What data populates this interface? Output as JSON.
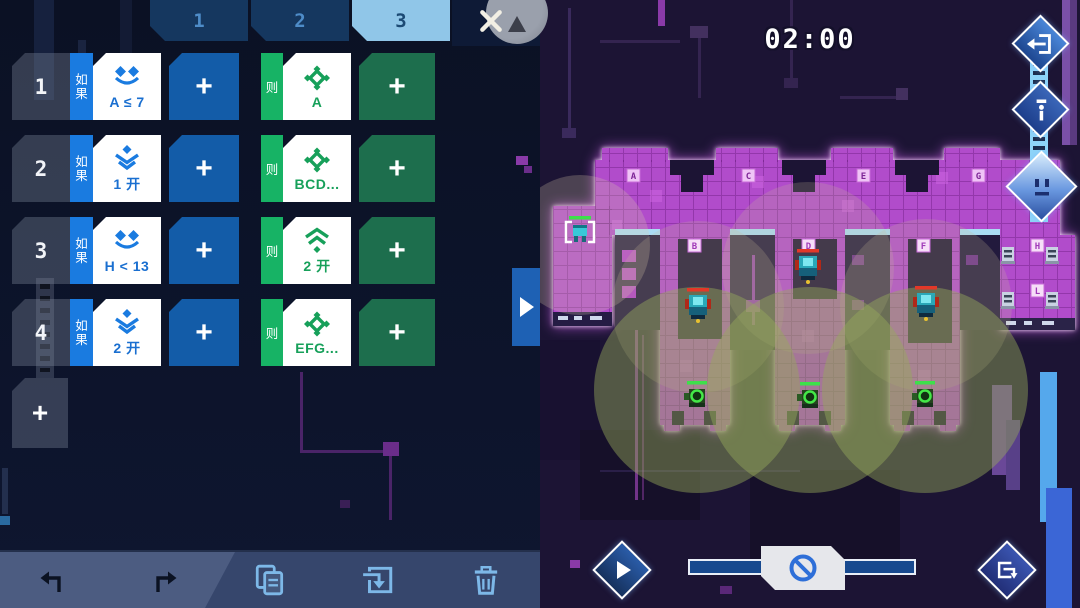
{
  "colors": {
    "accent_blue": "#1a7be0",
    "accent_green": "#17b365",
    "card_text_blue": "#1a6fd0",
    "card_text_green": "#17a05a",
    "map_magenta": "#b14ccb",
    "toolbar_icon_blue": "#7db8e8",
    "side_strip_blue": "#8ed4f8"
  },
  "left_panel": {
    "tabs": [
      {
        "label": "1"
      },
      {
        "label": "2"
      },
      {
        "label": "3",
        "active": true
      }
    ],
    "rules": [
      {
        "index": "1",
        "if_label": "如果",
        "condition_icon": "scan-eyes-icon",
        "condition": "A ≤ 7",
        "add_condition": "+",
        "then_label": "则",
        "action_icon": "move-target-icon",
        "action": "A",
        "add_action": "+"
      },
      {
        "index": "2",
        "if_label": "如果",
        "condition_icon": "stack-down-icon",
        "condition": "1 开",
        "add_condition": "+",
        "then_label": "则",
        "action_icon": "move-target-icon",
        "action": "BCD...",
        "add_action": "+"
      },
      {
        "index": "3",
        "if_label": "如果",
        "condition_icon": "scan-eyes-icon",
        "condition": "H < 13",
        "add_condition": "+",
        "then_label": "则",
        "action_icon": "signal-up-icon",
        "action": "2 开",
        "add_action": "+"
      },
      {
        "index": "4",
        "if_label": "如果",
        "condition_icon": "stack-down-icon",
        "condition": "2 开",
        "add_condition": "+",
        "then_label": "则",
        "action_icon": "move-target-icon",
        "action": "EFG...",
        "add_action": "+"
      }
    ],
    "add_rule_label": "+",
    "toolbar_icons": [
      "undo-icon",
      "redo-icon",
      "copy-icon",
      "import-icon",
      "trash-icon"
    ]
  },
  "game_panel": {
    "timer": "02:00",
    "markers": [
      "A",
      "C",
      "E",
      "G",
      "B",
      "D",
      "F",
      "H",
      "L"
    ],
    "side_buttons": [
      "exit-icon",
      "info-icon",
      "robot-face-icon"
    ],
    "controls": [
      "play-icon",
      "speed-slider",
      "no-entry-icon",
      "leave-level-icon"
    ],
    "units": {
      "ally_selected": 1,
      "enemy_robots": 3,
      "green_turrets": 3,
      "small_turrets": 4
    }
  }
}
